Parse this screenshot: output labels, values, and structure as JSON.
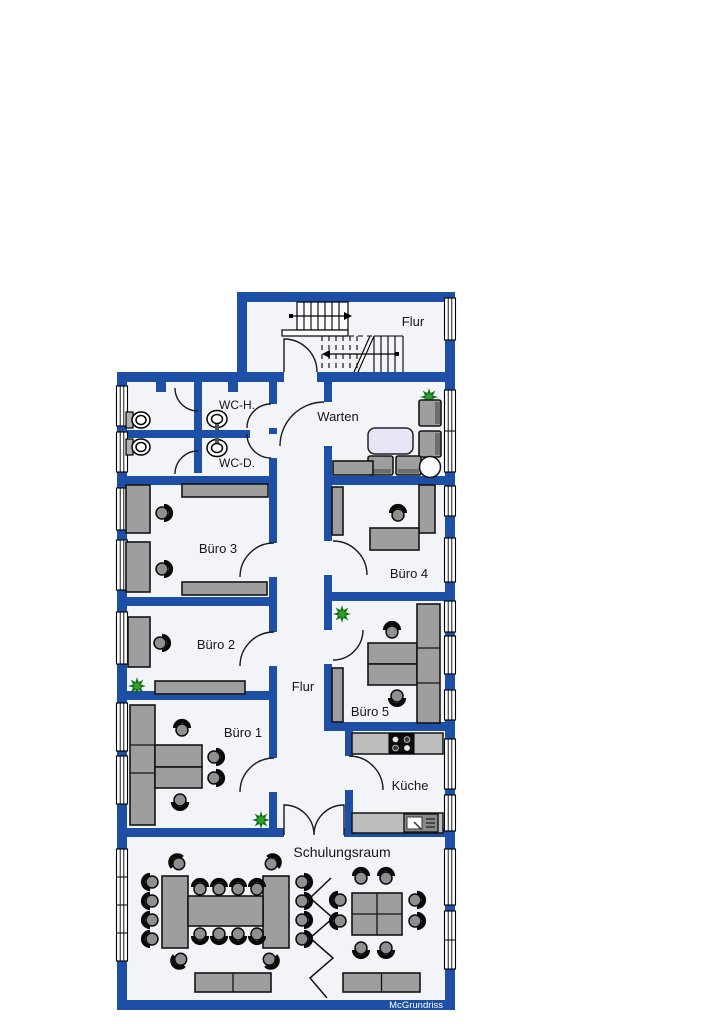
{
  "watermark": "McGrundriss",
  "colors": {
    "wall": "#1d4fa6",
    "floor": "#f2f4f8",
    "furniture": "#9e9e9e",
    "furniture_outline": "#141414",
    "counter": "#bdbdbd",
    "chair_seat": "#8f8f8f",
    "chair_back": "#0a0a0a",
    "plant_dark": "#166b16",
    "plant_light": "#2da12d",
    "table_lavender": "#e6e6f7"
  },
  "rooms": {
    "stair_hall": {
      "label": "Flur"
    },
    "wc_men": {
      "label": "WC-H."
    },
    "wc_women": {
      "label": "WC-D."
    },
    "waiting": {
      "label": "Warten"
    },
    "office3": {
      "label": "Büro 3"
    },
    "office4": {
      "label": "Büro 4"
    },
    "office2": {
      "label": "Büro 2"
    },
    "corridor": {
      "label": "Flur"
    },
    "office5": {
      "label": "Büro 5"
    },
    "office1": {
      "label": "Büro 1"
    },
    "kitchen": {
      "label": "Küche"
    },
    "training": {
      "label": "Schulungsraum"
    }
  }
}
